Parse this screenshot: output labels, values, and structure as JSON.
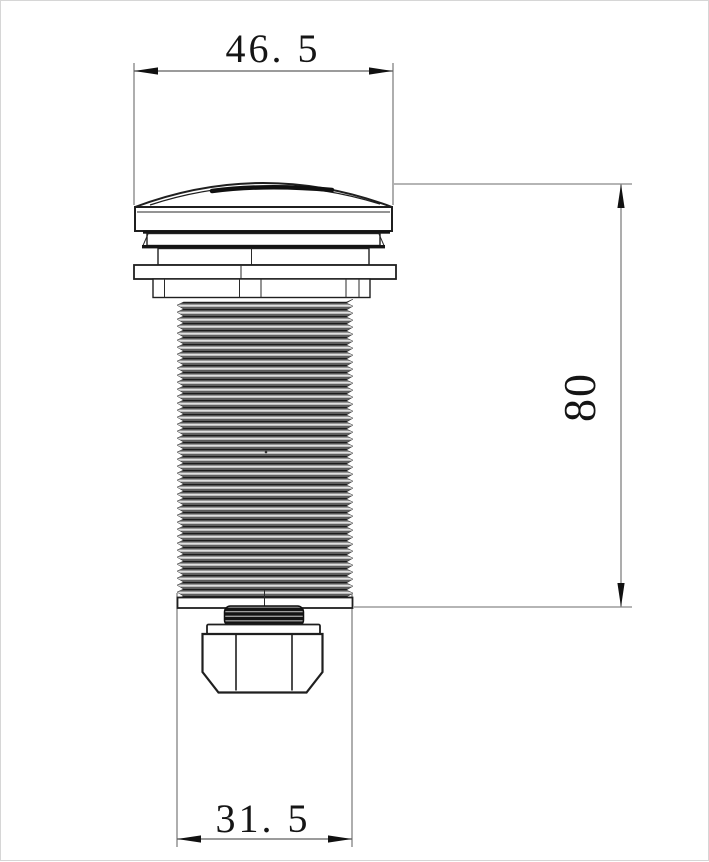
{
  "drawing": {
    "type": "technical-dimension-drawing",
    "part": "dome-head threaded push button with mounting flange and hex nut",
    "dimensions": {
      "cap_diameter": "46. 5",
      "overall_length": "80",
      "thread_diameter": "31. 5"
    },
    "colors": {
      "background": "#ffffff",
      "outline": "#1f1f1f",
      "dim_line": "#6b6b6b",
      "text": "#151515",
      "frame": "#d6d6d6"
    }
  }
}
